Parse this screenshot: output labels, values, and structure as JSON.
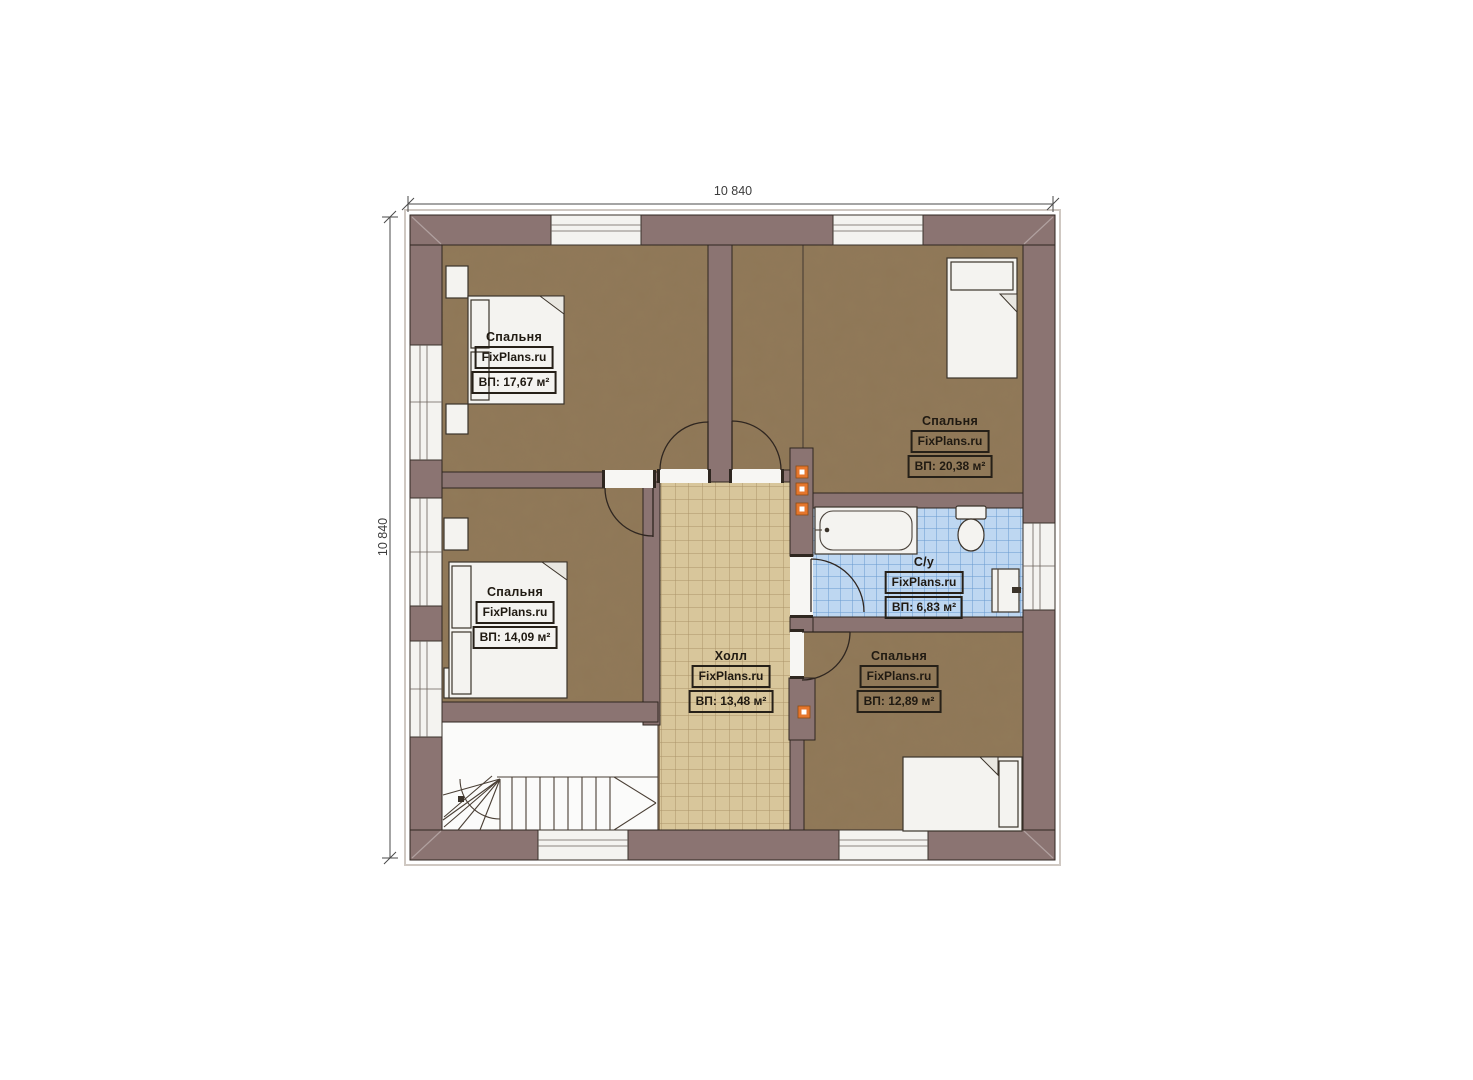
{
  "plan": {
    "dimensions": {
      "top": "10 840",
      "left": "10 840"
    },
    "rooms": [
      {
        "id": "bedroom-top-left",
        "name": "Спальня",
        "brand": "FixPlans.ru",
        "area": "ВП: 17,67 м²"
      },
      {
        "id": "bedroom-top-right",
        "name": "Спальня",
        "brand": "FixPlans.ru",
        "area": "ВП: 20,38 м²"
      },
      {
        "id": "bedroom-middle-left",
        "name": "Спальня",
        "brand": "FixPlans.ru",
        "area": "ВП: 14,09 м²"
      },
      {
        "id": "bathroom",
        "name": "С/у",
        "brand": "FixPlans.ru",
        "area": "ВП: 6,83 м²"
      },
      {
        "id": "hall",
        "name": "Холл",
        "brand": "FixPlans.ru",
        "area": "ВП: 13,48 м²"
      },
      {
        "id": "bedroom-bottom-right",
        "name": "Спальня",
        "brand": "FixPlans.ru",
        "area": "ВП: 12,89 м²"
      }
    ],
    "colors": {
      "wall": "#8b7472",
      "bedroom_floor": "#8f7757",
      "hall_floor": "#d8c69b",
      "bath_floor": "#bed7f1",
      "vent": "#e5762c",
      "outline": "#2f2620"
    }
  }
}
